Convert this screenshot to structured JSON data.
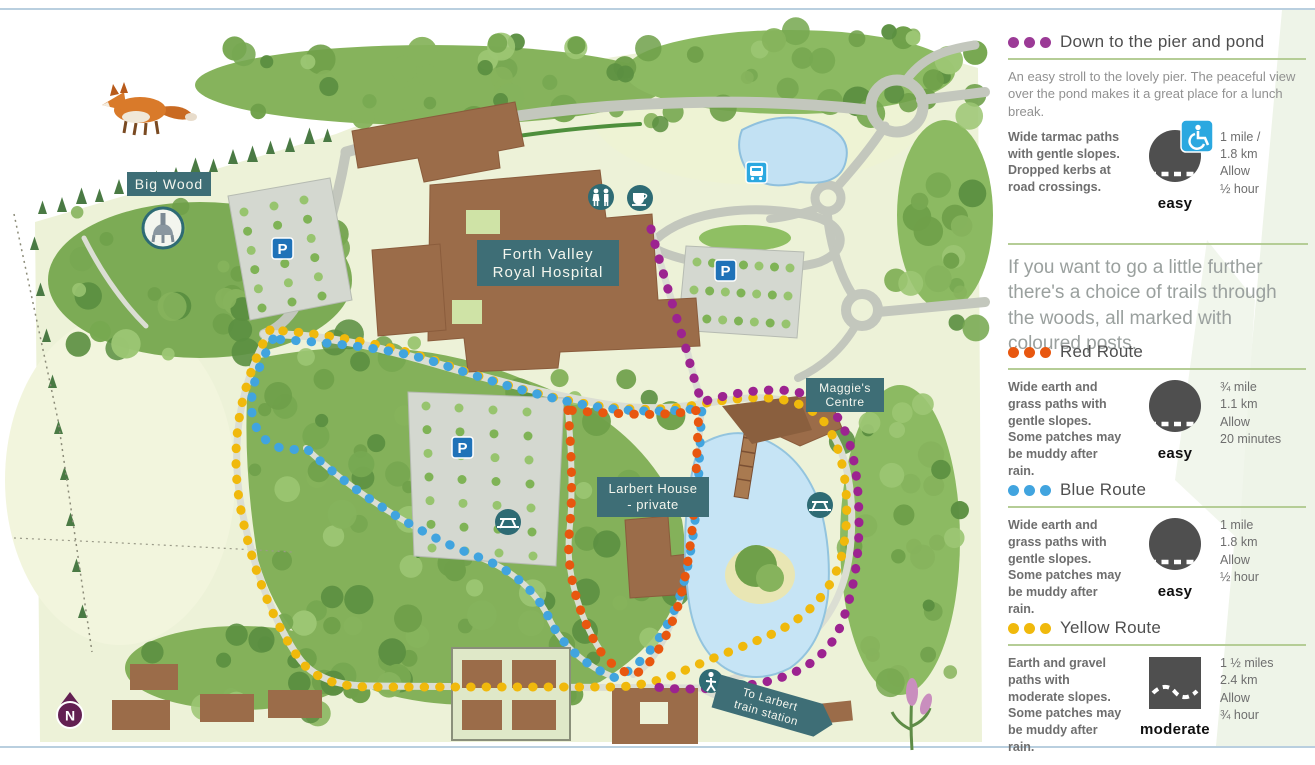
{
  "page": {
    "rule_color": "#b9cfdf"
  },
  "map": {
    "label_bg": "#3e6e76",
    "icon_teal": "#2e6b74",
    "parking_blue": "#1f72b8",
    "bus_blue": "#2ba8e0",
    "compass_purple": "#632052",
    "labels": {
      "big_wood": "Big Wood",
      "hospital_line1": "Forth Valley",
      "hospital_line2": "Royal Hospital",
      "maggies_line1": "Maggie's",
      "maggies_line2": "Centre",
      "larbert_line1": "Larbert House",
      "larbert_line2": "- private",
      "station_line1": "To Larbert",
      "station_line2": "train station",
      "parking": "P",
      "compass_n": "N"
    },
    "icons": [
      "fox",
      "roman-helmet-badge",
      "parking-sign",
      "bus-stop",
      "toilets",
      "cafe",
      "picnic-table",
      "pedestrian",
      "cyclist",
      "north-compass",
      "flower"
    ],
    "routes": [
      {
        "name": "Down to the pier and pond",
        "color": "#9c2390"
      },
      {
        "name": "Red Route",
        "color": "#e8570f"
      },
      {
        "name": "Blue Route",
        "color": "#41a4df"
      },
      {
        "name": "Yellow Route",
        "color": "#f0b90c"
      }
    ]
  },
  "legend": {
    "interlude": "If you want to go a little further there's a choice of trails through the woods, all marked with coloured posts.",
    "sections": [
      {
        "title": "Down to the pier and pond",
        "dot_color": "#9b3a96",
        "intro": "An easy stroll to the lovely pier. The peaceful view over the pond makes it a great place for a lunch break.",
        "surface": "Wide tarmac paths with gentle slopes. Dropped kerbs at road crossings.",
        "difficulty": "easy",
        "icon": "easy-circle-with-wheelchair",
        "stats": [
          "1 mile /",
          "1.8 km",
          "Allow",
          "½ hour"
        ]
      },
      {
        "title": "Red Route",
        "dot_color": "#e8570f",
        "surface": "Wide earth and grass paths with gentle slopes. Some patches may be muddy after rain.",
        "difficulty": "easy",
        "icon": "easy-circle",
        "stats": [
          "¾ mile",
          "1.1 km",
          "Allow",
          "20 minutes"
        ]
      },
      {
        "title": "Blue Route",
        "dot_color": "#41a4df",
        "surface": "Wide earth and grass paths with gentle slopes. Some patches may be muddy after rain.",
        "difficulty": "easy",
        "icon": "easy-circle",
        "stats": [
          "1 mile",
          "1.8 km",
          "Allow",
          "½ hour"
        ]
      },
      {
        "title": "Yellow Route",
        "dot_color": "#f0b90c",
        "surface": "Earth and gravel paths with moderate slopes. Some patches may be muddy after rain.",
        "difficulty": "moderate",
        "icon": "moderate-square",
        "stats": [
          "1 ½ miles",
          "2.4 km",
          "Allow",
          "¾ hour"
        ]
      }
    ]
  }
}
